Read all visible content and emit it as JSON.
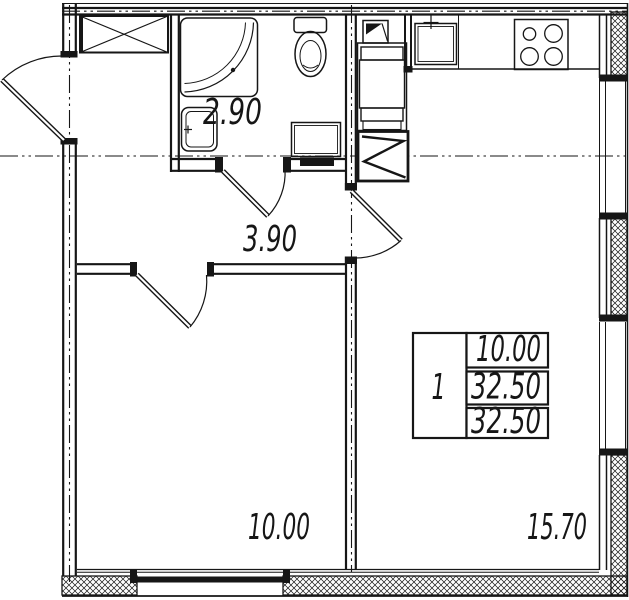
{
  "plan": {
    "rooms": [
      {
        "id": "bathroom",
        "area": "2.90"
      },
      {
        "id": "hallway",
        "area": "3.90"
      },
      {
        "id": "bedroom",
        "area": "10.00"
      },
      {
        "id": "kitchen-living-room",
        "area": "15.70"
      }
    ],
    "info_table": {
      "room_count": "1",
      "living_area": "10.00",
      "total_area": "32.50",
      "overall_area": "32.50"
    },
    "icons": {
      "shower": "shower-cabin-icon",
      "toilet": "toilet-icon",
      "sink": "washbasin-icon",
      "washer": "washing-machine-icon",
      "stove": "stove-4-burner-icon",
      "kitchen_sink": "kitchen-sink-icon",
      "vent": "vent-shaft-icon",
      "wardrobe": "wardrobe-cross-icon"
    },
    "colors": {
      "line": "#161616",
      "background": "#ffffff"
    }
  }
}
